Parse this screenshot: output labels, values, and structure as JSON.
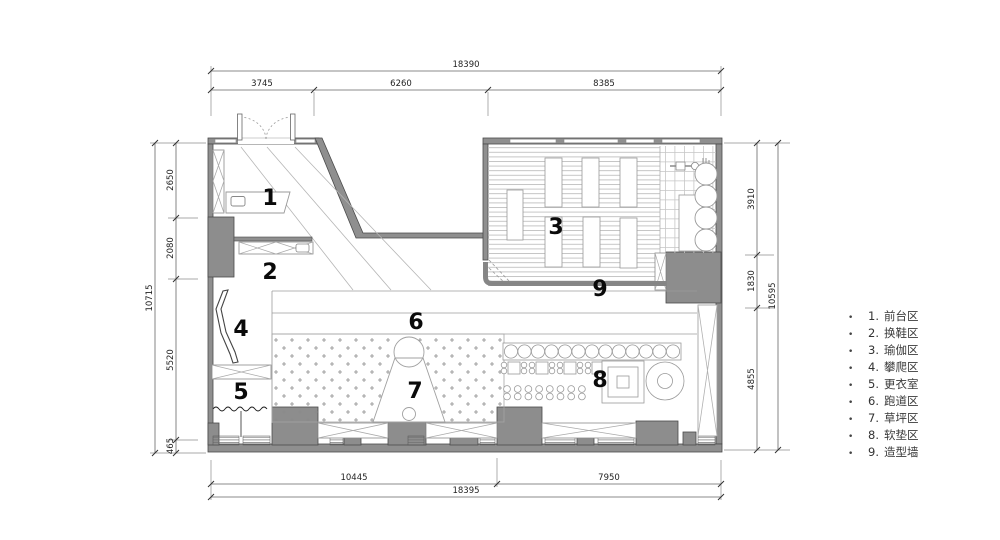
{
  "drawing": {
    "type": "floor-plan",
    "colors": {
      "wall": "#8f8f8f",
      "wall_edge": "#4a4a4a",
      "thin_line": "#a0a0a0",
      "ink": "#0a0a0a",
      "dim_ink": "#222222"
    },
    "area_numbers": [
      "1",
      "2",
      "3",
      "4",
      "5",
      "6",
      "7",
      "8",
      "9"
    ]
  },
  "dimensions": {
    "top": {
      "total": "18390",
      "segments": [
        "3745",
        "6260",
        "8385"
      ]
    },
    "bottom": {
      "total": "18395",
      "segments": [
        "10445",
        "7950"
      ]
    },
    "left": {
      "total": "10715",
      "segments": [
        "2650",
        "2080",
        "5520",
        "465"
      ]
    },
    "right": {
      "total": "10595",
      "segments": [
        "3910",
        "1830",
        "4855"
      ]
    }
  },
  "legend": {
    "bullet": "•",
    "items": [
      {
        "no": "1.",
        "label": "前台区"
      },
      {
        "no": "2.",
        "label": "换鞋区"
      },
      {
        "no": "3.",
        "label": "瑜伽区"
      },
      {
        "no": "4.",
        "label": "攀爬区"
      },
      {
        "no": "5.",
        "label": "更衣室"
      },
      {
        "no": "6.",
        "label": "跑道区"
      },
      {
        "no": "7.",
        "label": "草坪区"
      },
      {
        "no": "8.",
        "label": "软垫区"
      },
      {
        "no": "9.",
        "label": "造型墙"
      }
    ]
  }
}
